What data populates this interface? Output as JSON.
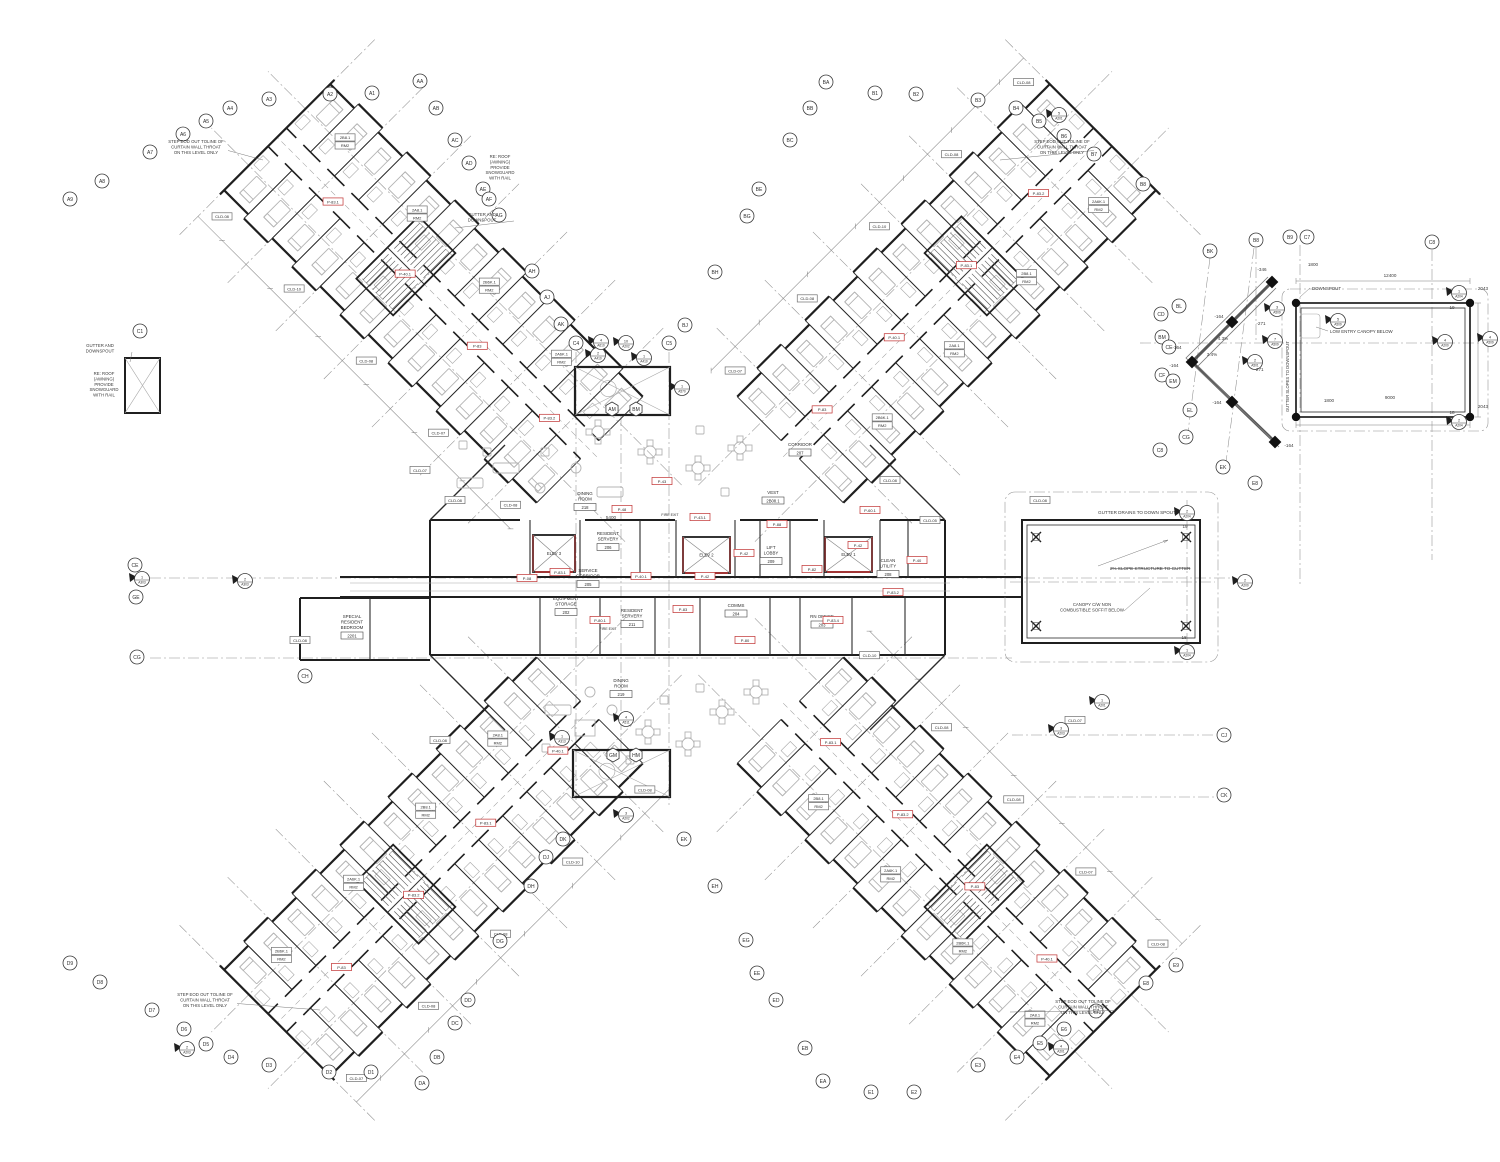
{
  "drawing": {
    "colors": {
      "wall": "#1f1f1f",
      "light_line": "#a8a8a8",
      "grid_line": "#8f8f8f",
      "tag_red": "#c03030",
      "furniture": "#b4b4b4"
    },
    "type": "architectural-floor-plan"
  },
  "grid_bubbles": [
    [
      "A1",
      372,
      93
    ],
    [
      "A2",
      330,
      94
    ],
    [
      "A3",
      269,
      99
    ],
    [
      "A4",
      230,
      108
    ],
    [
      "A5",
      206,
      121
    ],
    [
      "A6",
      183,
      134
    ],
    [
      "A7",
      150,
      152
    ],
    [
      "A8",
      102,
      181
    ],
    [
      "A9",
      70,
      199
    ],
    [
      "AA",
      420,
      81
    ],
    [
      "AB",
      436,
      108
    ],
    [
      "AC",
      455,
      140
    ],
    [
      "AD",
      469,
      163
    ],
    [
      "AE",
      483,
      189
    ],
    [
      "AF",
      489,
      199
    ],
    [
      "AG",
      499,
      215
    ],
    [
      "AH",
      532,
      271
    ],
    [
      "AJ",
      547,
      297
    ],
    [
      "AK",
      561,
      324
    ],
    [
      "BA",
      826,
      82
    ],
    [
      "BB",
      810,
      108
    ],
    [
      "BC",
      790,
      140
    ],
    [
      "BE",
      759,
      189
    ],
    [
      "BG",
      747,
      216
    ],
    [
      "BH",
      715,
      272
    ],
    [
      "BJ",
      685,
      325
    ],
    [
      "B1",
      875,
      93
    ],
    [
      "B2",
      916,
      94
    ],
    [
      "B3",
      978,
      100
    ],
    [
      "B4",
      1016,
      108
    ],
    [
      "B5",
      1039,
      121
    ],
    [
      "B6",
      1064,
      136
    ],
    [
      "B7",
      1094,
      154
    ],
    [
      "B8",
      1143,
      184
    ],
    [
      "BK",
      1210,
      251
    ],
    [
      "BL",
      1179,
      306
    ],
    [
      "CD",
      1161,
      314
    ],
    [
      "BM",
      1162,
      337
    ],
    [
      "CE",
      1169,
      347
    ],
    [
      "CF",
      1162,
      375
    ],
    [
      "EM",
      1173,
      381
    ],
    [
      "EL",
      1190,
      410
    ],
    [
      "CG",
      1186,
      437
    ],
    [
      "C8",
      1160,
      450
    ],
    [
      "EK",
      1223,
      467
    ],
    [
      "E8",
      1255,
      483
    ],
    [
      "B8",
      1256,
      240
    ],
    [
      "B9",
      1290,
      237
    ],
    [
      "C7",
      1307,
      237
    ],
    [
      "C8",
      1432,
      242
    ],
    [
      "C1",
      140,
      331
    ],
    [
      "C4",
      576,
      343
    ],
    [
      "C5",
      669,
      343
    ],
    [
      "CE",
      135,
      565
    ],
    [
      "GE",
      136,
      597
    ],
    [
      "CG",
      137,
      657
    ],
    [
      "CH",
      305,
      676
    ],
    [
      "CJ",
      1224,
      735
    ],
    [
      "CK",
      1224,
      795
    ],
    [
      "D1",
      371,
      1072
    ],
    [
      "D2",
      329,
      1072
    ],
    [
      "D3",
      269,
      1065
    ],
    [
      "D4",
      231,
      1057
    ],
    [
      "D5",
      206,
      1044
    ],
    [
      "D6",
      184,
      1029
    ],
    [
      "D7",
      152,
      1010
    ],
    [
      "D8",
      100,
      982
    ],
    [
      "D9",
      70,
      963
    ],
    [
      "DA",
      422,
      1083
    ],
    [
      "DB",
      437,
      1057
    ],
    [
      "DC",
      455,
      1023
    ],
    [
      "DD",
      468,
      1000
    ],
    [
      "DG",
      500,
      941
    ],
    [
      "DH",
      531,
      886
    ],
    [
      "DJ",
      546,
      857
    ],
    [
      "DK",
      563,
      839
    ],
    [
      "E1",
      871,
      1092
    ],
    [
      "E2",
      914,
      1092
    ],
    [
      "E3",
      978,
      1065
    ],
    [
      "E4",
      1017,
      1057
    ],
    [
      "E5",
      1040,
      1043
    ],
    [
      "E6",
      1064,
      1029
    ],
    [
      "E7",
      1096,
      1011
    ],
    [
      "E8",
      1146,
      983
    ],
    [
      "E9",
      1176,
      965
    ],
    [
      "EA",
      823,
      1081
    ],
    [
      "EB",
      805,
      1048
    ],
    [
      "ED",
      776,
      1000
    ],
    [
      "EE",
      757,
      973
    ],
    [
      "EG",
      746,
      940
    ],
    [
      "EH",
      715,
      886
    ],
    [
      "EK",
      684,
      839
    ]
  ],
  "hex_bubbles": [
    [
      "AM",
      612,
      409
    ],
    [
      "BM",
      636,
      409
    ],
    [
      "GM",
      613,
      755
    ],
    [
      "HM",
      636,
      755
    ]
  ],
  "detail_markers": [
    {
      "n": "5",
      "l": "A201",
      "x": 1059,
      "y": 115
    },
    {
      "n": "2",
      "l": "A410",
      "x": 598,
      "y": 355
    },
    {
      "n": "1",
      "l": "A410",
      "x": 644,
      "y": 358
    },
    {
      "n": "4",
      "l": "A610",
      "x": 601,
      "y": 342
    },
    {
      "n": "10",
      "l": "A202",
      "x": 626,
      "y": 343
    },
    {
      "n": "1",
      "l": "A570",
      "x": 682,
      "y": 388
    },
    {
      "n": "3",
      "l": "A202",
      "x": 626,
      "y": 815
    },
    {
      "n": "2",
      "l": "A203",
      "x": 187,
      "y": 1049
    },
    {
      "n": "4",
      "l": "A201",
      "x": 1061,
      "y": 1048
    },
    {
      "n": "1",
      "l": "A201",
      "x": 1102,
      "y": 702
    },
    {
      "n": "2",
      "l": "A204",
      "x": 1187,
      "y": 513
    },
    {
      "n": "1",
      "l": "A204",
      "x": 1187,
      "y": 652
    },
    {
      "n": "1",
      "l": "A204",
      "x": 1459,
      "y": 293
    },
    {
      "n": "2",
      "l": "A204",
      "x": 1459,
      "y": 422
    },
    {
      "n": "2",
      "l": "A200",
      "x": 1245,
      "y": 582
    },
    {
      "n": "4",
      "l": "A200",
      "x": 1445,
      "y": 342
    },
    {
      "n": "1",
      "l": "A303",
      "x": 142,
      "y": 579
    },
    {
      "n": "2",
      "l": "A303",
      "x": 245,
      "y": 581
    },
    {
      "n": "3",
      "l": "A509",
      "x": 1277,
      "y": 309
    },
    {
      "n": "7",
      "l": "A509",
      "x": 1275,
      "y": 341
    },
    {
      "n": "2",
      "l": "A501",
      "x": 1255,
      "y": 362
    },
    {
      "n": "4",
      "l": "A509",
      "x": 1490,
      "y": 339
    },
    {
      "n": "5",
      "l": "A509",
      "x": 1338,
      "y": 321
    },
    {
      "n": "4",
      "l": "A511",
      "x": 626,
      "y": 719
    },
    {
      "n": "1",
      "l": "A313",
      "x": 562,
      "y": 738
    },
    {
      "n": "3",
      "l": "A203",
      "x": 1061,
      "y": 730
    }
  ],
  "annotations": [
    {
      "t": "STEP EOD OUT TOLINE OF|CURTAIN WALL THROAT|ON THIS LEVEL ONLY",
      "x": 196,
      "y": 143,
      "lx": 263,
      "ly": 160
    },
    {
      "t": "STEP EOD OUT TOLINE OF|CURTAIN WALL THROAT|ON THIS LEVEL ONLY",
      "x": 1062,
      "y": 143,
      "lx": 1000,
      "ly": 160
    },
    {
      "t": "STEP EOD OUT TOLINE OF|CURTAIN WALL THROAT|ON THIS LEVEL ONLY",
      "x": 205,
      "y": 996,
      "lx": 320,
      "ly": 1010
    },
    {
      "t": "STEP EOD OUT TOLINE OF|CURTAIN WALL THROAT|ON THIS LEVEL ONLY",
      "x": 1083,
      "y": 1003,
      "lx": 1010,
      "ly": 1012
    },
    {
      "t": "RE: ROOF|(AWNING)|PROVIDE|SNOWGUARD|WITH RAIL",
      "x": 104,
      "y": 375
    },
    {
      "t": "RE: ROOF|(AWNING)|PROVIDE|SNOWGUARD|WITH RAIL",
      "x": 500,
      "y": 158
    },
    {
      "t": "GUTTER AND|DOWNSPOUT",
      "x": 100,
      "y": 347,
      "lx": 130,
      "ly": 362
    },
    {
      "t": "GUTTER AND|DOWNSPOUT",
      "x": 482,
      "y": 216,
      "lx": 455,
      "ly": 228
    },
    {
      "t": "CANOPY C/W NON|COMBUSTIBLE SOFFIT BELOW",
      "x": 1092,
      "y": 606,
      "lx": 1150,
      "ly": 588
    }
  ],
  "courtyard": {
    "gutter_note": "GUTTER DRAINS TO DOWN SPOUT",
    "slope_note": "2% SLOPE STRUCTURE TO GUTTER",
    "col_top": "19",
    "col_bottom": "18"
  },
  "canopy": {
    "downspout_label": "DOWNSPOUT",
    "low_entry_note": "LOW ENTRY CANOPY BELOW",
    "gutter_slope_note": "GUTTER SLOPES TO DOWNSPOUT"
  },
  "dim_texts": [
    {
      "t": "1800",
      "x": 1313,
      "y": 266
    },
    {
      "t": "1800",
      "x": 1329,
      "y": 402
    },
    {
      "t": "2043",
      "x": 1483,
      "y": 290
    },
    {
      "t": "2043",
      "x": 1483,
      "y": 408
    },
    {
      "t": "12400",
      "x": 1390,
      "y": 277
    },
    {
      "t": "9000",
      "x": 1390,
      "y": 399
    },
    {
      "t": "-346",
      "x": 1262,
      "y": 271
    },
    {
      "t": "-271",
      "x": 1261,
      "y": 325
    },
    {
      "t": "-271",
      "x": 1259,
      "y": 371
    },
    {
      "t": "-164",
      "x": 1219,
      "y": 318
    },
    {
      "t": "-164",
      "x": 1177,
      "y": 349
    },
    {
      "t": "-164",
      "x": 1174,
      "y": 367
    },
    {
      "t": "-164",
      "x": 1217,
      "y": 404
    },
    {
      "t": "-164",
      "x": 1289,
      "y": 447
    },
    {
      "t": "3.4%",
      "x": 1212,
      "y": 356
    },
    {
      "t": "4.3%",
      "x": 1223,
      "y": 340
    },
    {
      "t": "19",
      "x": 1452,
      "y": 309
    },
    {
      "t": "18",
      "x": 1452,
      "y": 414
    },
    {
      "t": "19",
      "x": 1185,
      "y": 528
    },
    {
      "t": "18",
      "x": 1184,
      "y": 639
    },
    {
      "t": "5400",
      "x": 611,
      "y": 519
    }
  ],
  "rooms": [
    {
      "n": "EQUIPMENT|STORAGE",
      "num": "202",
      "x": 566,
      "y": 600
    },
    {
      "n": "SERVICE|CORRIDOR",
      "num": "205",
      "x": 588,
      "y": 572
    },
    {
      "n": "RESIDENT|SERVERY",
      "num": "206",
      "x": 608,
      "y": 535
    },
    {
      "n": "RESIDENT|SERVERY",
      "num": "211",
      "x": 632,
      "y": 612
    },
    {
      "n": "COMMS",
      "num": "204",
      "x": 736,
      "y": 607
    },
    {
      "n": "RN OFFICE",
      "num": "203",
      "x": 822,
      "y": 618
    },
    {
      "n": "CLEAN|UTILITY",
      "num": "208",
      "x": 888,
      "y": 562
    },
    {
      "n": "LIFT|LOBBY",
      "num": "209",
      "x": 771,
      "y": 549
    },
    {
      "n": "VEST",
      "num": "2B08.1",
      "x": 773,
      "y": 494
    },
    {
      "n": "DINING|ROOM",
      "num": "218",
      "x": 585,
      "y": 495
    },
    {
      "n": "DINING|ROOM",
      "num": "219",
      "x": 621,
      "y": 682
    },
    {
      "n": "CORRIDOR",
      "num": "207",
      "x": 800,
      "y": 446
    },
    {
      "n": "SPECIAL|RESIDENT|BEDROOM",
      "num": "2201",
      "x": 352,
      "y": 618
    }
  ],
  "elevators": [
    {
      "l": "ELEV 3",
      "x": 533,
      "y": 535,
      "w": 42,
      "h": 37
    },
    {
      "l": "ELEV 2",
      "x": 683,
      "y": 537,
      "w": 47,
      "h": 36
    },
    {
      "l": "ELEV 1",
      "x": 825,
      "y": 537,
      "w": 47,
      "h": 35
    }
  ],
  "fire_exits": [
    {
      "t": "FIRE EXIT",
      "x": 670,
      "y": 516
    },
    {
      "t": "FIRE EXIT",
      "x": 608,
      "y": 630
    }
  ],
  "red_tags": [
    [
      527,
      578,
      "P-08"
    ],
    [
      560,
      572,
      "P-83.1"
    ],
    [
      641,
      576,
      "P-40.1"
    ],
    [
      600,
      620,
      "P-80.1"
    ],
    [
      683,
      609,
      "P-83"
    ],
    [
      744,
      553,
      "P-42"
    ],
    [
      700,
      517,
      "P-43.1"
    ],
    [
      777,
      524,
      "P-88"
    ],
    [
      812,
      569,
      "P-82"
    ],
    [
      858,
      545,
      "P-42"
    ],
    [
      893,
      592,
      "P-83.2"
    ],
    [
      833,
      620,
      "P-83.4"
    ],
    [
      745,
      640,
      "P-80"
    ],
    [
      622,
      509,
      "P-48"
    ],
    [
      662,
      481,
      "P-43"
    ],
    [
      705,
      576,
      "P-42"
    ],
    [
      870,
      510,
      "P-60.1"
    ],
    [
      917,
      560,
      "P-40"
    ]
  ],
  "cld_tags": [
    [
      455,
      500,
      "CLD-08"
    ],
    [
      420,
      470,
      "CLD-07"
    ],
    [
      890,
      480,
      "CLD-08"
    ],
    [
      930,
      520,
      "CLD-05"
    ],
    [
      1040,
      500,
      "CLD-08"
    ],
    [
      300,
      640,
      "CLD-08"
    ],
    [
      1075,
      720,
      "CLD-07"
    ],
    [
      440,
      740,
      "CLD-08"
    ]
  ],
  "wing_tag_cycle": [
    "P-83.2",
    "P-83",
    "P-40.1",
    "P-83.1"
  ],
  "wing_cld_cycle": [
    "CLD-08",
    "CLD-07",
    "CLD-08",
    "CLD-10",
    "CLD-08"
  ],
  "wing_room_ids": [
    [
      "2A6K.1",
      "RM2"
    ],
    [
      "2B6K.1",
      "RM2"
    ],
    [
      "2A8.1",
      "RM2"
    ],
    [
      "2B8.1",
      "RM2"
    ]
  ],
  "wings": [
    {
      "id": "wing-northwest",
      "x": 618,
      "y": 478,
      "a": -135
    },
    {
      "id": "wing-northeast",
      "x": 762,
      "y": 478,
      "a": -45
    },
    {
      "id": "wing-southwest",
      "x": 618,
      "y": 682,
      "a": 135
    },
    {
      "id": "wing-southeast",
      "x": 762,
      "y": 682,
      "a": 45
    }
  ],
  "terraces": [
    {
      "x": 575,
      "y": 367,
      "w": 95,
      "h": 48
    },
    {
      "x": 573,
      "y": 750,
      "w": 97,
      "h": 47
    }
  ],
  "gridlines": [
    [
      576,
      352,
      576,
      800
    ],
    [
      669,
      352,
      669,
      808
    ],
    [
      621,
      415,
      621,
      752
    ],
    [
      1300,
      245,
      1300,
      585
    ],
    [
      1432,
      250,
      1432,
      560
    ],
    [
      1256,
      248,
      1256,
      340
    ],
    [
      1187,
      500,
      1187,
      660
    ],
    [
      150,
      578,
      1235,
      578
    ],
    [
      150,
      658,
      1012,
      658
    ],
    [
      1012,
      735,
      1215,
      735
    ],
    [
      1046,
      797,
      1215,
      797
    ],
    [
      1140,
      343,
      1490,
      343
    ],
    [
      1010,
      582,
      1215,
      582
    ],
    [
      1210,
      258,
      1188,
      432
    ],
    [
      1254,
      248,
      1226,
      462
    ]
  ],
  "furniture": [
    [
      598,
      432,
      "t4"
    ],
    [
      650,
      452,
      "t4"
    ],
    [
      698,
      468,
      "t4"
    ],
    [
      740,
      448,
      "t4"
    ],
    [
      470,
      483,
      "sf"
    ],
    [
      506,
      468,
      "sf"
    ],
    [
      540,
      488,
      "rd"
    ],
    [
      463,
      445,
      "ch"
    ],
    [
      487,
      452,
      "ch"
    ],
    [
      610,
      492,
      "sf"
    ],
    [
      576,
      468,
      "rd"
    ],
    [
      700,
      430,
      "ch"
    ],
    [
      725,
      492,
      "ch"
    ],
    [
      545,
      452,
      "ch"
    ],
    [
      585,
      728,
      "pn"
    ],
    [
      558,
      710,
      "sf"
    ],
    [
      546,
      748,
      "ch"
    ],
    [
      612,
      710,
      "rd"
    ],
    [
      648,
      732,
      "t4"
    ],
    [
      688,
      744,
      "t4"
    ],
    [
      722,
      712,
      "t4"
    ],
    [
      756,
      692,
      "t4"
    ],
    [
      700,
      688,
      "ch"
    ],
    [
      590,
      692,
      "rd"
    ],
    [
      630,
      760,
      "ch"
    ],
    [
      664,
      700,
      "ch"
    ]
  ]
}
